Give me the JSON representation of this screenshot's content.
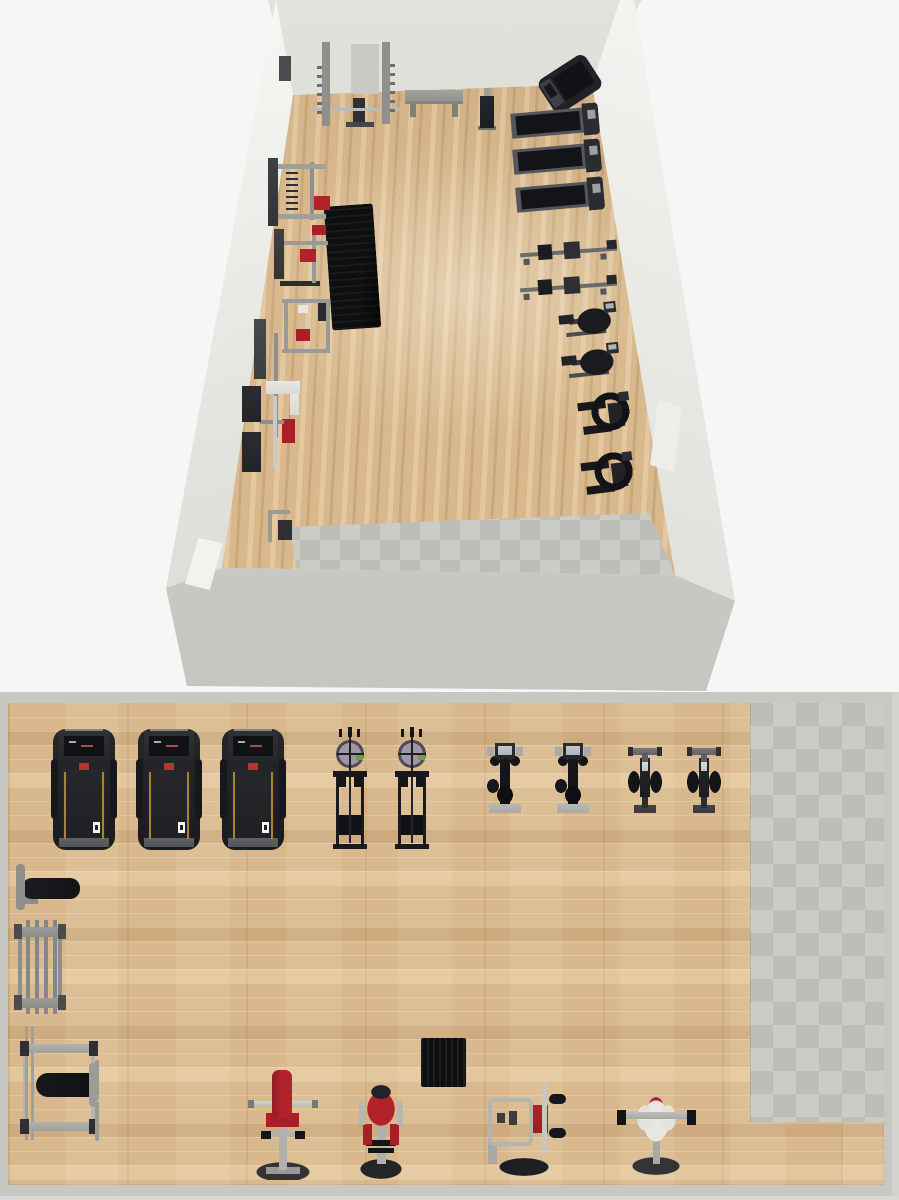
{
  "app": {
    "description": "gym room planner render",
    "views": [
      "3d-overview",
      "2d-floor-plan"
    ]
  },
  "palette": {
    "bg": "#f6f6f7",
    "wood": "#d8b88c",
    "tile": "#c6c6c1",
    "wall": "#c7c8c2",
    "accent_red": "#b1222b",
    "accent_yellow": "#c8a62f",
    "machine_black": "#17181b",
    "frame_gray": "#b0b1ad"
  },
  "view3d": {
    "items": [
      {
        "name": "wall-sign",
        "type": "sign3",
        "x": 279,
        "y": 56,
        "w": 12,
        "h": 25
      },
      {
        "name": "power-rack",
        "type": "rack3",
        "x": 312,
        "y": 40,
        "w": 88,
        "h": 96
      },
      {
        "name": "gym-bench",
        "type": "bench3",
        "x": 405,
        "y": 84,
        "w": 58,
        "h": 34
      },
      {
        "name": "upright-bench",
        "type": "bench3b",
        "x": 476,
        "y": 88,
        "w": 22,
        "h": 42
      },
      {
        "name": "treadmill",
        "type": "tmang3",
        "x": 542,
        "y": 64,
        "w": 56,
        "h": 40,
        "rot": -33
      },
      {
        "name": "treadmill",
        "type": "tm3",
        "x": 511,
        "y": 106,
        "w": 88,
        "h": 32,
        "rot": -5
      },
      {
        "name": "treadmill",
        "type": "tm3",
        "x": 513,
        "y": 142,
        "w": 88,
        "h": 33,
        "rot": -5
      },
      {
        "name": "treadmill",
        "type": "tm3",
        "x": 516,
        "y": 180,
        "w": 88,
        "h": 33,
        "rot": -5
      },
      {
        "name": "rowing-machine",
        "type": "rower3",
        "x": 520,
        "y": 239,
        "w": 97,
        "h": 24,
        "rot": -4
      },
      {
        "name": "rowing-machine",
        "type": "rower3",
        "x": 520,
        "y": 274,
        "w": 97,
        "h": 24,
        "rot": -4
      },
      {
        "name": "exercise-bike",
        "type": "bike3",
        "x": 555,
        "y": 301,
        "w": 62,
        "h": 38,
        "rot": -6
      },
      {
        "name": "exercise-bike",
        "type": "bike3",
        "x": 558,
        "y": 342,
        "w": 62,
        "h": 44,
        "rot": -6
      },
      {
        "name": "elliptical-trainer",
        "type": "ellip3",
        "x": 563,
        "y": 387,
        "w": 70,
        "h": 60,
        "rot": -7
      },
      {
        "name": "elliptical-trainer",
        "type": "ellip3",
        "x": 566,
        "y": 447,
        "w": 70,
        "h": 56,
        "rot": -7
      },
      {
        "name": "exercise-mat",
        "type": "mat3",
        "x": 328,
        "y": 205,
        "w": 49,
        "h": 124,
        "rot": -4
      },
      {
        "name": "lat-pulldown-machine",
        "type": "latA3",
        "x": 266,
        "y": 152,
        "w": 68,
        "h": 82
      },
      {
        "name": "weight-machine",
        "type": "latB3",
        "x": 272,
        "y": 219,
        "w": 64,
        "h": 72
      },
      {
        "name": "weight-machine",
        "type": "latC3",
        "x": 268,
        "y": 291,
        "w": 70,
        "h": 68
      },
      {
        "name": "chest-press-machine",
        "type": "latD3",
        "x": 252,
        "y": 315,
        "w": 54,
        "h": 145
      },
      {
        "name": "plate-loaded-machine",
        "type": "latE3",
        "x": 240,
        "y": 380,
        "w": 65,
        "h": 95
      },
      {
        "name": "weight-machine",
        "type": "small3",
        "x": 262,
        "y": 506,
        "w": 32,
        "h": 40
      },
      {
        "name": "door",
        "type": "door3L",
        "x": 185,
        "y": 538,
        "w": 38,
        "h": 52
      },
      {
        "name": "door",
        "type": "door3R",
        "x": 650,
        "y": 400,
        "w": 32,
        "h": 72
      }
    ]
  },
  "plan2d": {
    "origin_y": 692,
    "items": [
      {
        "name": "treadmill",
        "type": "tm2",
        "x": 53,
        "y": 729,
        "w": 62,
        "h": 121
      },
      {
        "name": "treadmill",
        "type": "tm2",
        "x": 138,
        "y": 729,
        "w": 62,
        "h": 121
      },
      {
        "name": "treadmill",
        "type": "tm2",
        "x": 222,
        "y": 729,
        "w": 62,
        "h": 121
      },
      {
        "name": "cable-tower",
        "type": "tower2",
        "x": 333,
        "y": 727,
        "w": 34,
        "h": 123
      },
      {
        "name": "cable-tower",
        "type": "tower2",
        "x": 395,
        "y": 727,
        "w": 34,
        "h": 123
      },
      {
        "name": "exercise-bike",
        "type": "bike2",
        "x": 487,
        "y": 743,
        "w": 36,
        "h": 70
      },
      {
        "name": "exercise-bike",
        "type": "bike2",
        "x": 555,
        "y": 743,
        "w": 36,
        "h": 70
      },
      {
        "name": "spin-bike",
        "type": "spin2",
        "x": 628,
        "y": 745,
        "w": 34,
        "h": 68
      },
      {
        "name": "spin-bike",
        "type": "spin2",
        "x": 687,
        "y": 745,
        "w": 34,
        "h": 68
      },
      {
        "name": "flat-bench",
        "type": "bench2",
        "x": 14,
        "y": 862,
        "w": 74,
        "h": 50
      },
      {
        "name": "barbell-rack",
        "type": "rack2",
        "x": 14,
        "y": 920,
        "w": 52,
        "h": 94
      },
      {
        "name": "bench-press-station",
        "type": "press2",
        "x": 20,
        "y": 1025,
        "w": 83,
        "h": 118
      },
      {
        "name": "preacher-bench",
        "type": "preacher2",
        "x": 248,
        "y": 1068,
        "w": 70,
        "h": 112
      },
      {
        "name": "curl-machine",
        "type": "curl2",
        "x": 358,
        "y": 1083,
        "w": 46,
        "h": 98
      },
      {
        "name": "exercise-mat",
        "type": "mat2",
        "x": 421,
        "y": 1038,
        "w": 45,
        "h": 49
      },
      {
        "name": "shoulder-press-machine",
        "type": "shoulder2",
        "x": 487,
        "y": 1083,
        "w": 79,
        "h": 93
      },
      {
        "name": "pec-deck-machine",
        "type": "pec2",
        "x": 617,
        "y": 1095,
        "w": 79,
        "h": 83
      }
    ]
  }
}
